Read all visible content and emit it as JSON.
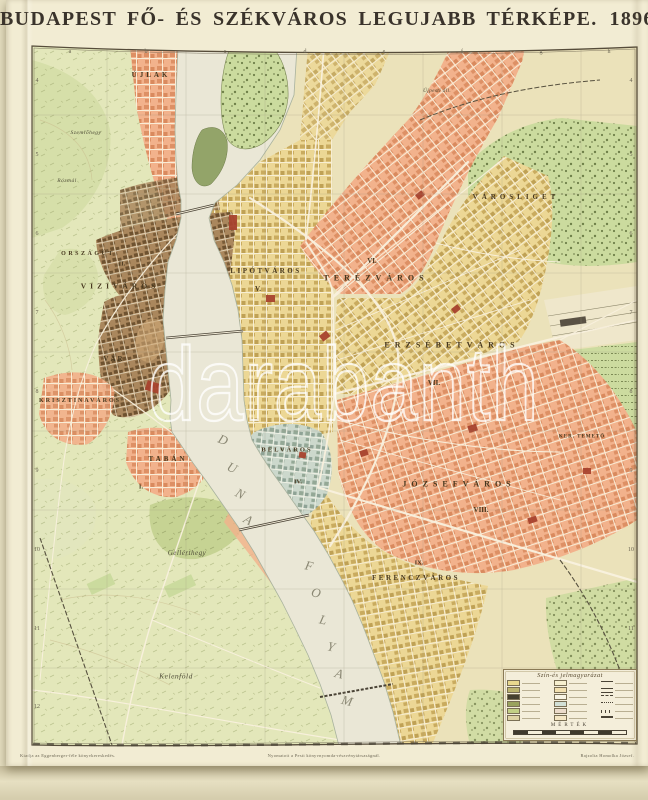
{
  "title": {
    "main": "BUDAPEST FŐ- ÉS SZÉKVÁROS LEGUJABB TÉRKÉPE.",
    "year": "1896."
  },
  "palette": {
    "paper": "#f2ecd3",
    "backing": "#e7e0c2",
    "pest_base": "#ebe2ba",
    "buda_hills": "#e3e7ba",
    "river": "#eae7d6",
    "district_salmon": "#f2b28c",
    "district_yellow": "#ecd795",
    "district_teal": "#ccd8cc",
    "old_town_brown": "#aa875d",
    "park_green": "#cbdb9e",
    "landmark_red": "#a8432e",
    "frame": "#564c3a",
    "label_ink": "#47381f"
  },
  "map": {
    "district_labels": [
      {
        "text": "ÚJLAK",
        "x": 151,
        "y": 75,
        "fs": 7,
        "ls": 3
      },
      {
        "text": "Szemlőhegy",
        "x": 86,
        "y": 133,
        "fs": 5.5,
        "ls": 0.5,
        "cls": "script"
      },
      {
        "text": "Rózmál",
        "x": 67,
        "y": 181,
        "fs": 5.5,
        "ls": 0.5,
        "cls": "script"
      },
      {
        "text": "ORSZÁGÚT",
        "x": 88,
        "y": 254,
        "fs": 6,
        "ls": 2.5
      },
      {
        "text": "II.",
        "x": 122,
        "y": 264,
        "fs": 6.5,
        "ls": 0
      },
      {
        "text": "VIZIVÁROS",
        "x": 120,
        "y": 286,
        "fs": 7.5,
        "ls": 4
      },
      {
        "text": "VÁR",
        "x": 114,
        "y": 359,
        "fs": 7,
        "ls": 2
      },
      {
        "text": "KRISZTINAVÁROS",
        "x": 80,
        "y": 401,
        "fs": 6,
        "ls": 2
      },
      {
        "text": "TABÁN",
        "x": 168,
        "y": 459,
        "fs": 7,
        "ls": 3
      },
      {
        "text": "I.",
        "x": 141,
        "y": 487,
        "fs": 6.5,
        "ls": 0
      },
      {
        "text": "Gellérthegy",
        "x": 187,
        "y": 553,
        "fs": 7,
        "ls": 0.5,
        "cls": "script"
      },
      {
        "text": "Kelenföld",
        "x": 176,
        "y": 676,
        "fs": 7.5,
        "ls": 0.5,
        "cls": "script"
      },
      {
        "text": "Újpesti áll.",
        "x": 437,
        "y": 91,
        "fs": 5.5,
        "ls": 0.3,
        "cls": "script"
      },
      {
        "text": "LIPÓTVÁROS",
        "x": 266,
        "y": 271,
        "fs": 7,
        "ls": 2.5
      },
      {
        "text": "V.",
        "x": 258,
        "y": 289,
        "fs": 7,
        "ls": 0
      },
      {
        "text": "VI.",
        "x": 372,
        "y": 261,
        "fs": 7,
        "ls": 0
      },
      {
        "text": "TERÉZVÁROS",
        "x": 376,
        "y": 278,
        "fs": 8,
        "ls": 5
      },
      {
        "text": "ERZSÉBETVÁROS",
        "x": 452,
        "y": 345,
        "fs": 8,
        "ls": 5
      },
      {
        "text": "VII.",
        "x": 434,
        "y": 383,
        "fs": 7,
        "ls": 0
      },
      {
        "text": "VÁROSLIGET",
        "x": 516,
        "y": 197,
        "fs": 7,
        "ls": 4
      },
      {
        "text": "KER. TEMETŐ",
        "x": 582,
        "y": 437,
        "fs": 5,
        "ls": 1
      },
      {
        "text": "JÓZSEFVÁROS",
        "x": 459,
        "y": 484,
        "fs": 8,
        "ls": 5
      },
      {
        "text": "VIII.",
        "x": 481,
        "y": 510,
        "fs": 7,
        "ls": 0
      },
      {
        "text": "IX.",
        "x": 419,
        "y": 563,
        "fs": 6.5,
        "ls": 0
      },
      {
        "text": "FERENCZVÁROS",
        "x": 416,
        "y": 578,
        "fs": 7,
        "ls": 2.5
      },
      {
        "text": "BELVÁROS",
        "x": 287,
        "y": 450,
        "fs": 6.5,
        "ls": 2
      },
      {
        "text": "IV.",
        "x": 298,
        "y": 482,
        "fs": 6.5,
        "ls": 0
      }
    ],
    "river_letters": [
      {
        "t": "D",
        "x": 223,
        "y": 440,
        "rot": 22
      },
      {
        "t": "U",
        "x": 232,
        "y": 468,
        "rot": 25
      },
      {
        "t": "N",
        "x": 240,
        "y": 494,
        "rot": 27
      },
      {
        "t": "A",
        "x": 248,
        "y": 520,
        "rot": 29
      },
      {
        "t": "F",
        "x": 309,
        "y": 566,
        "rot": 12
      },
      {
        "t": "O",
        "x": 316,
        "y": 593,
        "rot": 13
      },
      {
        "t": "L",
        "x": 323,
        "y": 620,
        "rot": 13
      },
      {
        "t": "Y",
        "x": 331,
        "y": 647,
        "rot": 14
      },
      {
        "t": "A",
        "x": 339,
        "y": 674,
        "rot": 14
      },
      {
        "t": "M",
        "x": 347,
        "y": 701,
        "rot": 14
      }
    ],
    "grid": {
      "top_letters": [
        {
          "t": "a",
          "x": 70,
          "y": 52
        },
        {
          "t": "b",
          "x": 146,
          "y": 52
        },
        {
          "t": "c",
          "x": 225,
          "y": 52
        },
        {
          "t": "d",
          "x": 305,
          "y": 52
        },
        {
          "t": "e",
          "x": 384,
          "y": 52
        },
        {
          "t": "f",
          "x": 462,
          "y": 52
        },
        {
          "t": "g",
          "x": 541,
          "y": 52
        },
        {
          "t": "h",
          "x": 609,
          "y": 52
        }
      ],
      "left_numbers": [
        {
          "t": "4",
          "x": 37,
          "y": 81
        },
        {
          "t": "5",
          "x": 37,
          "y": 155
        },
        {
          "t": "6",
          "x": 37,
          "y": 234
        },
        {
          "t": "7",
          "x": 37,
          "y": 313
        },
        {
          "t": "8",
          "x": 37,
          "y": 392
        },
        {
          "t": "9",
          "x": 37,
          "y": 471
        },
        {
          "t": "10",
          "x": 37,
          "y": 550
        },
        {
          "t": "11",
          "x": 37,
          "y": 629
        },
        {
          "t": "12",
          "x": 37,
          "y": 707
        }
      ],
      "right_numbers": [
        {
          "t": "4",
          "x": 631,
          "y": 81
        },
        {
          "t": "5",
          "x": 631,
          "y": 155
        },
        {
          "t": "6",
          "x": 631,
          "y": 234
        },
        {
          "t": "7",
          "x": 631,
          "y": 313
        },
        {
          "t": "8",
          "x": 631,
          "y": 392
        },
        {
          "t": "9",
          "x": 631,
          "y": 471
        },
        {
          "t": "10",
          "x": 631,
          "y": 550
        },
        {
          "t": "11",
          "x": 631,
          "y": 629
        },
        {
          "t": "12",
          "x": 631,
          "y": 707
        }
      ]
    }
  },
  "legend": {
    "title": "Szín-és jelmagyarázat",
    "scale_label": "MÉRTÉK",
    "col1": [
      {
        "color": "#e9d88e"
      },
      {
        "color": "#bcb46e"
      },
      {
        "color": "#45402f"
      },
      {
        "color": "#99a25d"
      },
      {
        "color": "#c2cf85"
      },
      {
        "color": "#ded3a4"
      }
    ],
    "col2": [
      {
        "color": "#f6efcf"
      },
      {
        "color": "#f2e0b0"
      },
      {
        "color": "#f8f4e4"
      },
      {
        "color": "#d2e0d6"
      },
      {
        "color": "#ecdccb"
      },
      {
        "color": "#f4e7c4"
      }
    ],
    "col3": [
      {
        "sym": "line-solid"
      },
      {
        "sym": "line-double"
      },
      {
        "sym": "line-dashed"
      },
      {
        "sym": "line-dotted"
      },
      {
        "sym": "line-cross"
      },
      {
        "sym": "line-thick"
      }
    ]
  },
  "imprint": {
    "left": "Kiadja az Eggenberger-féle könyvkereskedés.",
    "center": "Nyomatott a Pesti könyvnyomda-részvénytársaságnál.",
    "right": "Rajzolta Homolka József."
  },
  "watermark": {
    "text": "darabanth"
  }
}
